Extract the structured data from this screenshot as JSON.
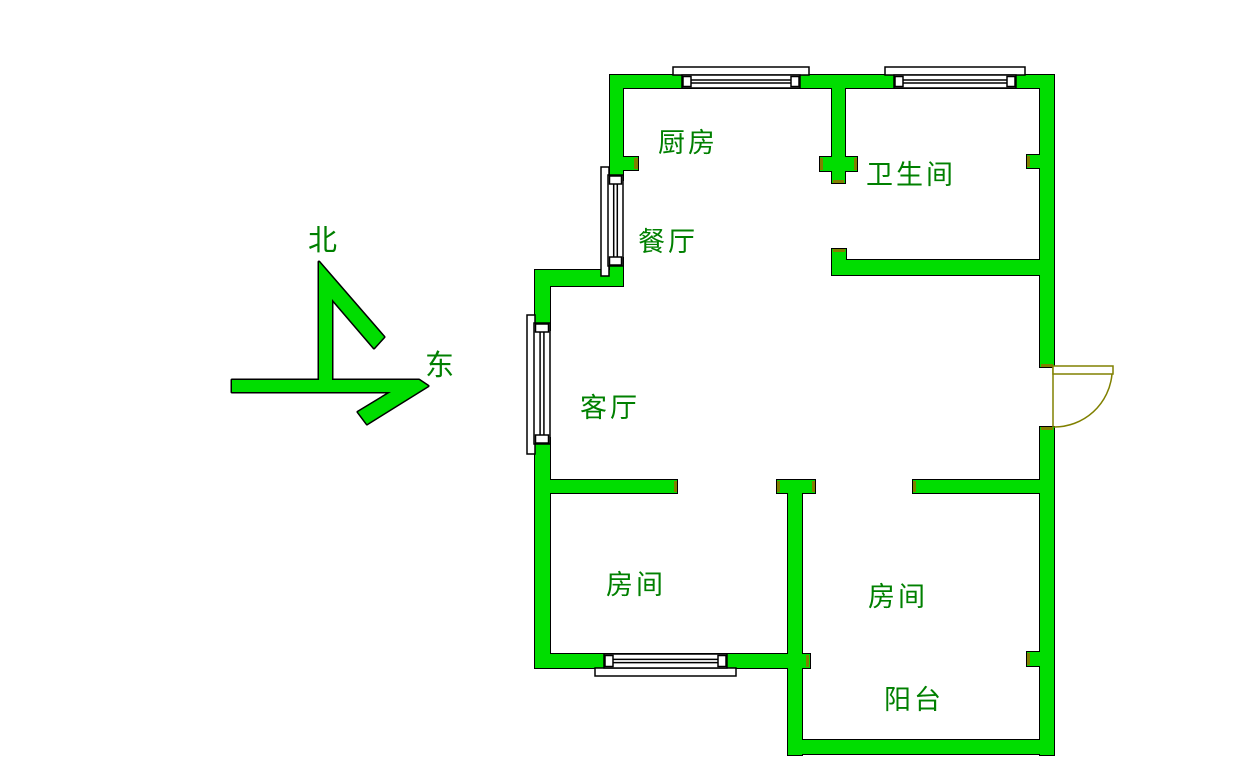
{
  "compass": {
    "north": "北",
    "east": "东"
  },
  "rooms": {
    "kitchen": "厨房",
    "bathroom": "卫生间",
    "dining": "餐厅",
    "living": "客厅",
    "bedroom_left": "房间",
    "bedroom_right": "房间",
    "balcony": "阳台"
  },
  "colors": {
    "background": "#ffffff",
    "wall_fill": "#00dd00",
    "outline": "#000000",
    "label_text": "#008000",
    "door_frame": "#808000",
    "window_fill": "#ffffff"
  }
}
